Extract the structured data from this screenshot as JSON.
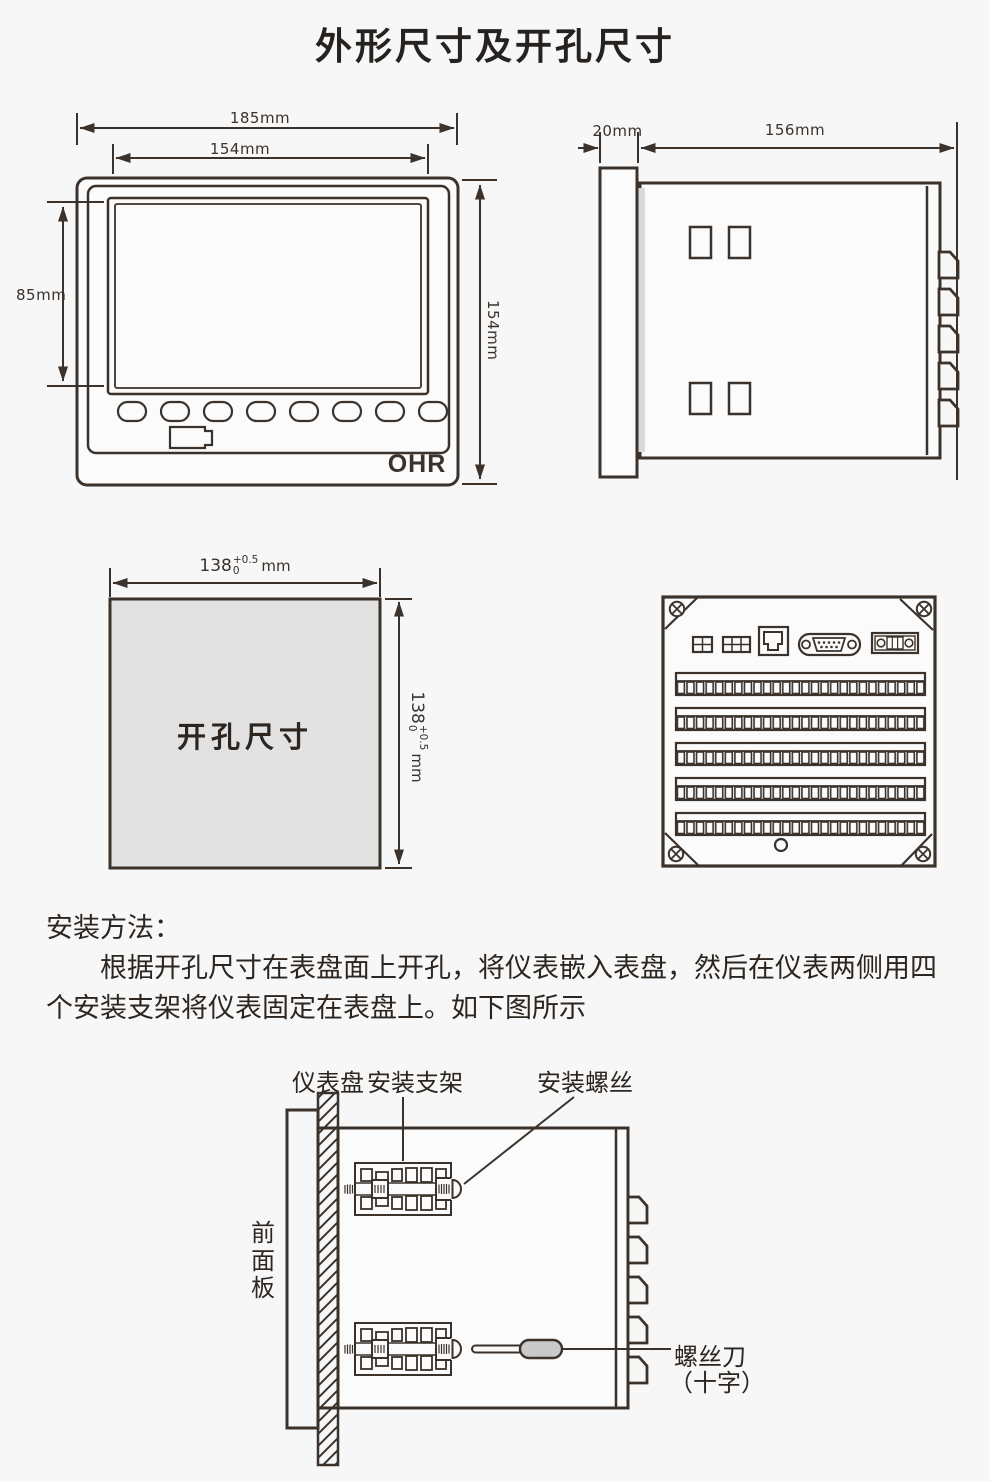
{
  "title": "外形尺寸及开孔尺寸",
  "front_view": {
    "brand": "OHR",
    "dim_outer_width": "185mm",
    "dim_inner_width": "154mm",
    "dim_screen_height": "85mm",
    "dim_outer_height": "154mm"
  },
  "side_view": {
    "dim_bezel_depth": "20mm",
    "dim_body_depth": "156mm"
  },
  "cutout": {
    "label": "开孔尺寸",
    "dim_base": "138",
    "tol_plus": "+0.5",
    "tol_minus": "0",
    "unit": "mm"
  },
  "instructions": {
    "heading": "安装方法：",
    "line1": "根据开孔尺寸在表盘面上开孔，将仪表嵌入表盘，然后在仪表两侧用四",
    "line2": "个安装支架将仪表固定在表盘上。如下图所示"
  },
  "install_diagram": {
    "panel_label": "仪表盘",
    "bracket_label": "安装支架",
    "screw_label": "安装螺丝",
    "front_panel_label": "前面板",
    "screwdriver_label": "螺丝刀",
    "screwdriver_type": "（十字）"
  },
  "colors": {
    "line": "#3a322b",
    "background": "#f7f7f7",
    "cutout_fill": "#e2e2e2",
    "handle_fill": "#c9c9c9"
  }
}
